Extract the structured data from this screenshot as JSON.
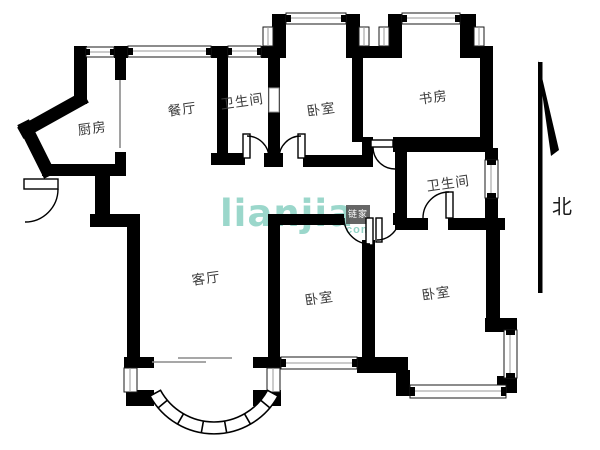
{
  "floorplan": {
    "title": "residential floor plan",
    "wall_color": "#000000",
    "rooms": [
      {
        "id": "kitchen",
        "label": "厨房"
      },
      {
        "id": "dining",
        "label": "餐厅"
      },
      {
        "id": "bathroom-top",
        "label": "卫生间"
      },
      {
        "id": "bedroom-top",
        "label": "卧室"
      },
      {
        "id": "study",
        "label": "书房"
      },
      {
        "id": "bathroom-mid",
        "label": "卫生间"
      },
      {
        "id": "living",
        "label": "客厅"
      },
      {
        "id": "bedroom-mid",
        "label": "卧室"
      },
      {
        "id": "bedroom-right",
        "label": "卧室"
      }
    ],
    "compass": {
      "label": "北"
    },
    "watermark": {
      "brand": "lianjia",
      "seal": "链家",
      "suffix": "com",
      "color": "#7fccbd"
    }
  }
}
